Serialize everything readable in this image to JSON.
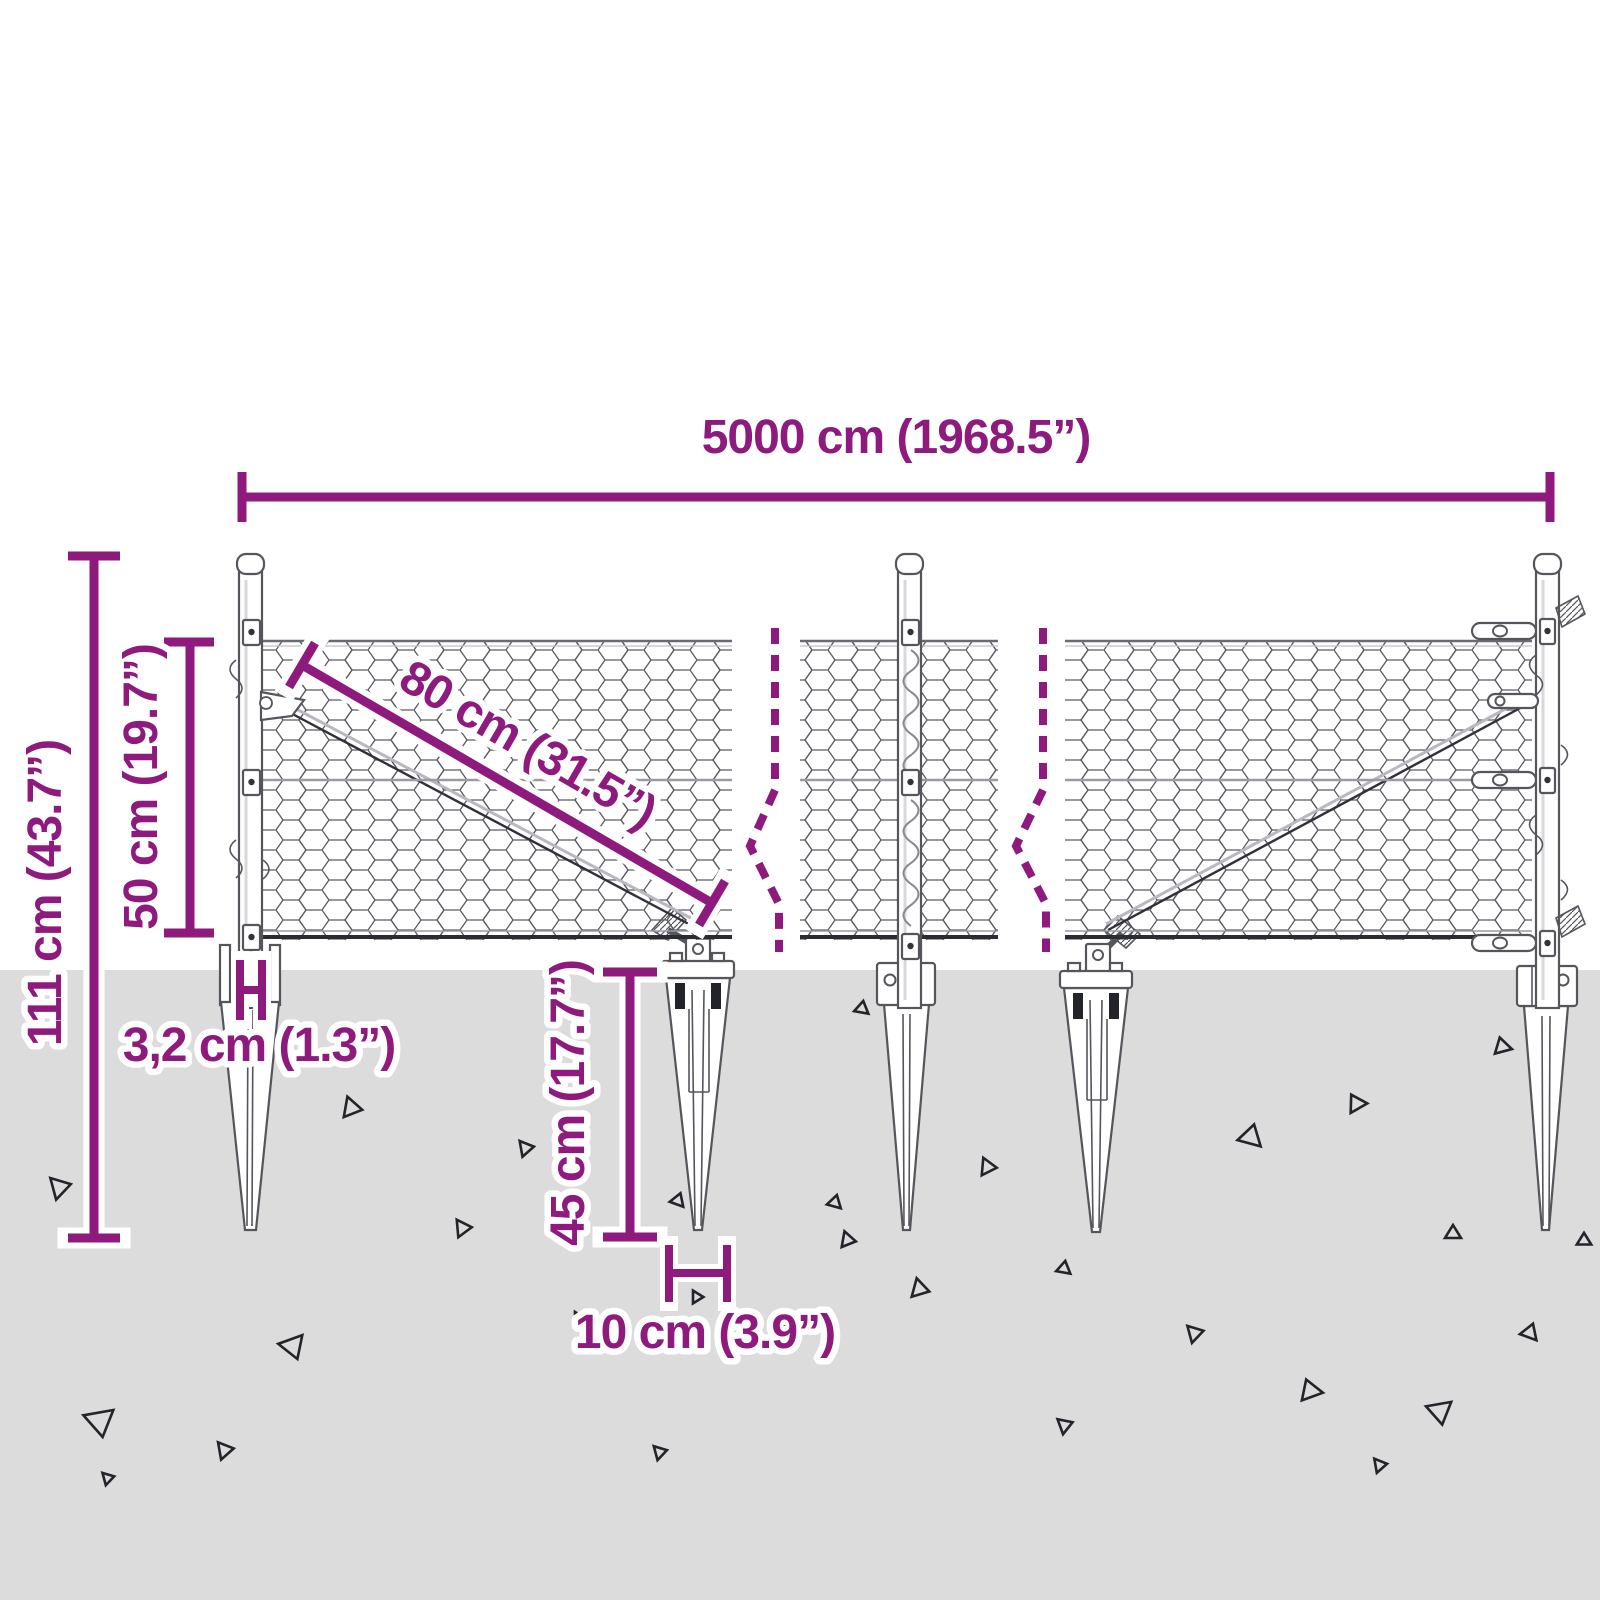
{
  "diagram": {
    "subject": "Chain-link / chicken wire fence kit with ground spike anchors — dimension drawing",
    "dimensions": {
      "total_length": "5000 cm (1968.5”)",
      "total_height": "111 cm (43.7”)",
      "mesh_height": "50 cm (19.7”)",
      "mesh_diagonal": "80 cm (31.5”)",
      "post_width": "3,2 cm (1.3”)",
      "spike_depth": "45 cm (17.7”)",
      "spike_width": "10 cm (3.9”)"
    },
    "parts": {
      "posts": 3,
      "ground_spikes": 5,
      "mesh_panels": 3,
      "break_marks": 2
    }
  },
  "colors": {
    "accent": "#8e1a7d",
    "ground": "#dcdcdc",
    "line": "#55555c",
    "line-dark": "#23232a",
    "mesh": "#5a5a62",
    "wire": "#9a9aa2",
    "paper": "#ffffff"
  }
}
